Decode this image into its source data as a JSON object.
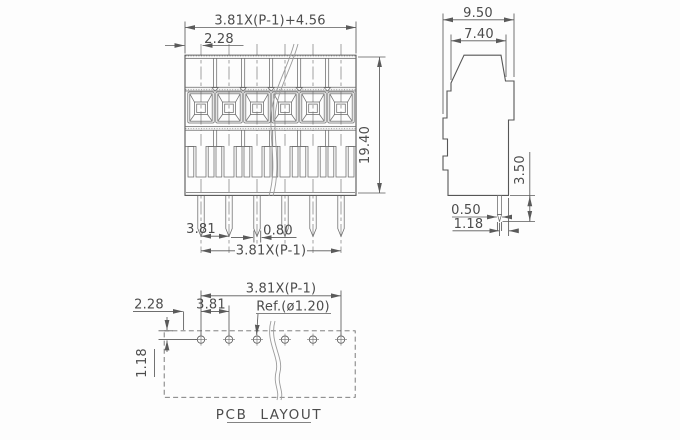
{
  "drawing": {
    "positions": 6,
    "front_view": {
      "dim_overall_width": "3.81X(P-1)+4.56",
      "dim_edge_to_pin": "2.28",
      "dim_height": "19.40",
      "dim_pin_pitch": "3.81",
      "dim_pin_width": "0.80",
      "dim_pin_span": "3.81X(P-1)"
    },
    "side_view": {
      "dim_overall_depth": "9.50",
      "dim_body_depth": "7.40",
      "dim_pin_length": "3.50",
      "dim_pin_thickness": "0.50",
      "dim_pin_to_edge": "1.18"
    },
    "pcb_layout": {
      "title": "PCB LAYOUT",
      "dim_hole_span": "3.81X(P-1)",
      "dim_hole_pitch": "3.81",
      "dim_edge_to_hole": "2.28",
      "dim_hole_ref": "Ref.(ø1.20)",
      "dim_edge_to_row": "1.18"
    }
  }
}
